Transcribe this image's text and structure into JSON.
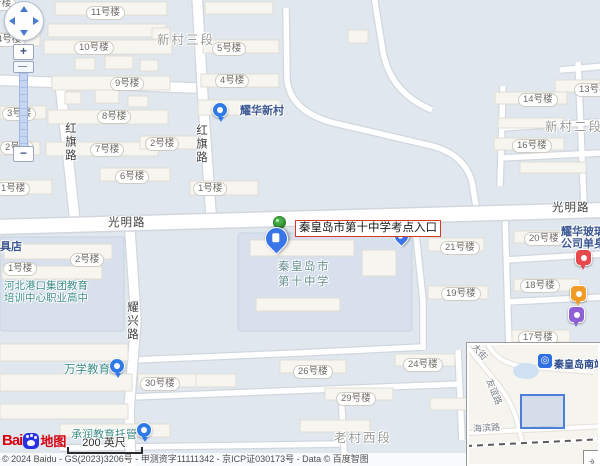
{
  "callout": {
    "text": "秦皇岛市第十中学考点入口"
  },
  "controls": {
    "zoom_in_label": "+",
    "zoom_out_label": "−"
  },
  "scalebar": {
    "text": "200 英尺"
  },
  "logo": {
    "word": "Bai",
    "suffix": "地图"
  },
  "copyright": {
    "text": "© 2024 Baidu - GS(2023)3206号 - 甲测资字11111342 - 京ICP证030173号 - Data © 百度智图"
  },
  "colors": {
    "callout_border": "#d43a2a",
    "pin_blue": "#3a75e8",
    "pin_green": "#43b043",
    "poi_red": "#e8474b",
    "poi_orange": "#f09b26",
    "poi_purple": "#8f5fd6",
    "poi_teal": "#3f8d86",
    "poi_navy": "#3b5692"
  },
  "inset": {
    "station_label": "秦皇岛南站",
    "expand_icon": "»",
    "road_labels": [
      {
        "text": "友谊路",
        "x": 12,
        "y": 40,
        "rot": 68
      },
      {
        "text": "海滨路",
        "x": 4,
        "y": 76,
        "rot": -4
      },
      {
        "text": "大街",
        "x": 2,
        "y": 0,
        "rot": 48
      }
    ]
  },
  "map": {
    "labels": [
      {
        "t": "8号楼",
        "x": -18,
        "y": -3,
        "k": "pill",
        "n": "building-label"
      },
      {
        "t": "11号楼",
        "x": 86,
        "y": 6,
        "k": "pill",
        "n": "building-label"
      },
      {
        "t": "4号楼",
        "x": -8,
        "y": 33,
        "k": "pill",
        "n": "building-label"
      },
      {
        "t": "10号楼",
        "x": 74,
        "y": 41,
        "k": "pill",
        "n": "building-label"
      },
      {
        "t": "5号楼",
        "x": 212,
        "y": 42,
        "k": "pill",
        "n": "building-label"
      },
      {
        "t": "9号楼",
        "x": 110,
        "y": 77,
        "k": "pill",
        "n": "building-label"
      },
      {
        "t": "4号楼",
        "x": 215,
        "y": 74,
        "k": "pill",
        "n": "building-label"
      },
      {
        "t": "8号楼",
        "x": 97,
        "y": 110,
        "k": "pill",
        "n": "building-label"
      },
      {
        "t": "3号楼",
        "x": 2,
        "y": 107,
        "k": "pill",
        "n": "building-label"
      },
      {
        "t": "7号楼",
        "x": 90,
        "y": 143,
        "k": "pill",
        "n": "building-label"
      },
      {
        "t": "2号楼",
        "x": 145,
        "y": 137,
        "k": "pill",
        "n": "building-label"
      },
      {
        "t": "2号楼",
        "x": 0,
        "y": 141,
        "k": "pill",
        "n": "building-label"
      },
      {
        "t": "6号楼",
        "x": 115,
        "y": 170,
        "k": "pill",
        "n": "building-label"
      },
      {
        "t": "1号楼",
        "x": -4,
        "y": 182,
        "k": "pill",
        "n": "building-label"
      },
      {
        "t": "1号楼",
        "x": 193,
        "y": 182,
        "k": "pill",
        "n": "building-label"
      },
      {
        "t": "13号楼",
        "x": 574,
        "y": 83,
        "k": "pill",
        "n": "building-label"
      },
      {
        "t": "14号楼",
        "x": 518,
        "y": 93,
        "k": "pill",
        "n": "building-label"
      },
      {
        "t": "16号楼",
        "x": 512,
        "y": 139,
        "k": "pill",
        "n": "building-label"
      },
      {
        "t": "20号楼",
        "x": 524,
        "y": 232,
        "k": "pill",
        "n": "building-label"
      },
      {
        "t": "21号楼",
        "x": 440,
        "y": 241,
        "k": "pill",
        "n": "building-label"
      },
      {
        "t": "19号楼",
        "x": 441,
        "y": 287,
        "k": "pill",
        "n": "building-label"
      },
      {
        "t": "18号楼",
        "x": 520,
        "y": 279,
        "k": "pill",
        "n": "building-label"
      },
      {
        "t": "17号楼",
        "x": 518,
        "y": 331,
        "k": "pill",
        "n": "building-label"
      },
      {
        "t": "2号楼",
        "x": 70,
        "y": 253,
        "k": "pill",
        "n": "building-label"
      },
      {
        "t": "1号楼",
        "x": 3,
        "y": 262,
        "k": "pill",
        "n": "building-label"
      },
      {
        "t": "30号楼",
        "x": 140,
        "y": 377,
        "k": "pill",
        "n": "building-label"
      },
      {
        "t": "26号楼",
        "x": 293,
        "y": 365,
        "k": "pill",
        "n": "building-label"
      },
      {
        "t": "24号楼",
        "x": 403,
        "y": 358,
        "k": "pill",
        "n": "building-label"
      },
      {
        "t": "29号楼",
        "x": 336,
        "y": 392,
        "k": "pill",
        "n": "building-label"
      },
      {
        "t": "新村三段",
        "x": 157,
        "y": 29,
        "k": "area halo",
        "n": "area-label"
      },
      {
        "t": "新村二段",
        "x": 545,
        "y": 116,
        "k": "area halo",
        "n": "area-label"
      },
      {
        "t": "老村西段",
        "x": 334,
        "y": 427,
        "k": "area halo",
        "n": "area-label"
      },
      {
        "t": "光明路",
        "x": 108,
        "y": 214,
        "k": "road halo",
        "n": "road-label-guangminglu"
      },
      {
        "t": "光明路",
        "x": 552,
        "y": 199,
        "k": "road halo",
        "n": "road-label-guangminglu"
      },
      {
        "t": "红旗路",
        "x": 62,
        "y": 122,
        "k": "road-v halo",
        "n": "road-label-hongqilu"
      },
      {
        "t": "红旗路",
        "x": 193,
        "y": 124,
        "k": "road-v halo",
        "n": "road-label-hongqilu"
      },
      {
        "t": "耀兴路",
        "x": 124,
        "y": 301,
        "k": "road-v halo",
        "n": "road-label-yaoxinglu"
      },
      {
        "t": "耀华新村",
        "x": 240,
        "y": 105,
        "k": "poi-navy halo",
        "n": "poi-label-yaohua-xincun"
      },
      {
        "t": "耀华玻璃\n公司单身",
        "x": 561,
        "y": 226,
        "k": "poi-navy halo",
        "n": "poi-label-yaohua-glass"
      },
      {
        "t": "家具店",
        "x": -11,
        "y": 241,
        "k": "poi-navy halo",
        "n": "poi-label-furniture-store"
      },
      {
        "t": "秦皇岛市\n第十中学",
        "x": 278,
        "y": 260,
        "k": "school halo",
        "n": "poi-label-no10-middle-school"
      },
      {
        "t": "河北港口集团教育\n培训中心职业高中",
        "x": 4,
        "y": 280,
        "k": "poi-teal halo",
        "n": "poi-label-hebei-port-school",
        "fs": "10.5px"
      },
      {
        "t": "万学教育",
        "x": 64,
        "y": 364,
        "k": "poi-teal halo",
        "n": "poi-label-wanxue-education",
        "fs": "11.5px"
      },
      {
        "t": "承润教育托管",
        "x": 71,
        "y": 429,
        "k": "poi-teal halo",
        "n": "poi-label-chengrun-education",
        "fs": "11px"
      }
    ],
    "markers": [
      {
        "kind": "dot",
        "x": 212,
        "y": 102,
        "n": "yaohua-xincun-poi-icon"
      },
      {
        "kind": "dot",
        "x": 109,
        "y": 358,
        "n": "wanxue-poi-icon"
      },
      {
        "kind": "dot",
        "x": 136,
        "y": 422,
        "n": "chengrun-poi-icon"
      },
      {
        "kind": "green-pin",
        "x": 273,
        "y": 216,
        "n": "exam-entrance-green-pin"
      },
      {
        "kind": "door-pin",
        "x": 265,
        "y": 227,
        "n": "school-gate-marker"
      },
      {
        "kind": "small-pin",
        "x": 394,
        "y": 229,
        "n": "secondary-gate-marker"
      },
      {
        "kind": "poi-pin",
        "x": 575,
        "y": 249,
        "c": "#e8474b",
        "n": "shop-poi-pin"
      },
      {
        "kind": "poi-pin",
        "x": 570,
        "y": 285,
        "c": "#f09b26",
        "n": "restaurant-poi-pin"
      },
      {
        "kind": "poi-pin",
        "x": 568,
        "y": 306,
        "c": "#8f5fd6",
        "n": "entertainment-poi-pin"
      }
    ]
  }
}
